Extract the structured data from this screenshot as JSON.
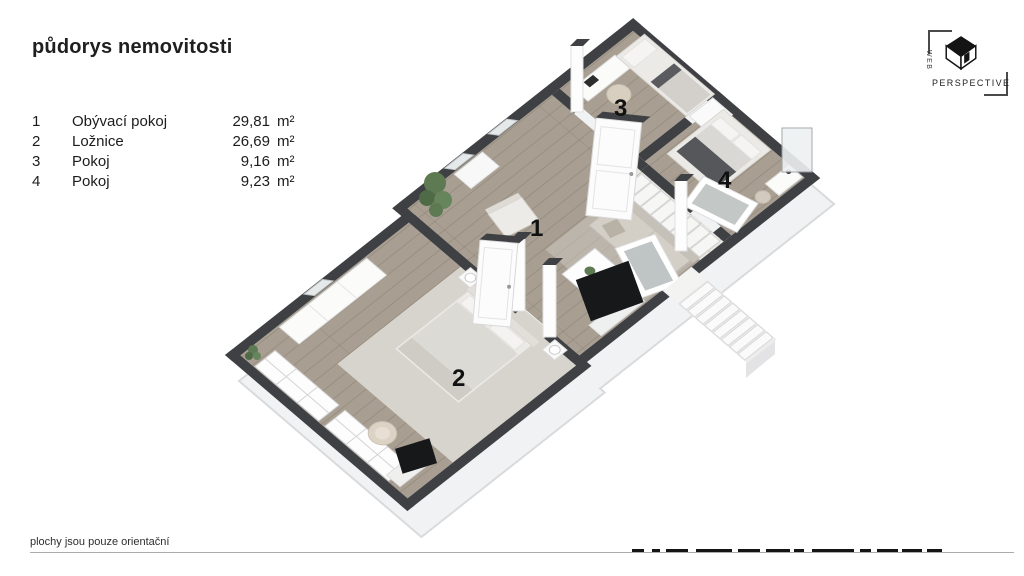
{
  "title": "půdorys nemovitosti",
  "legend": {
    "rows": [
      {
        "num": "1",
        "name": "Obývací pokoj",
        "value": "29,81",
        "unit": "m²"
      },
      {
        "num": "2",
        "name": "Ložnice",
        "value": "26,69",
        "unit": "m²"
      },
      {
        "num": "3",
        "name": "Pokoj",
        "value": "9,16",
        "unit": "m²"
      },
      {
        "num": "4",
        "name": "Pokoj",
        "value": "9,23",
        "unit": "m²"
      }
    ]
  },
  "plan": {
    "room_labels": {
      "living": "1",
      "bedroom": "2",
      "room3": "3",
      "room4": "4"
    }
  },
  "footer": {
    "note": "plochy jsou pouze orientační"
  },
  "logo": {
    "web": "WEB",
    "perspective": "PERSPECTIVE"
  },
  "colors": {
    "wall": "#3E4043",
    "floor": "#A89F92",
    "floor_light": "#E9E7E3",
    "rug": "#D7D3CD",
    "slab": "#F1F2F3",
    "sofa": "#D3CEC6",
    "furniture_light": "#ECEAE7",
    "accent_dark": "#17181A",
    "plant": "#5D7A53"
  }
}
